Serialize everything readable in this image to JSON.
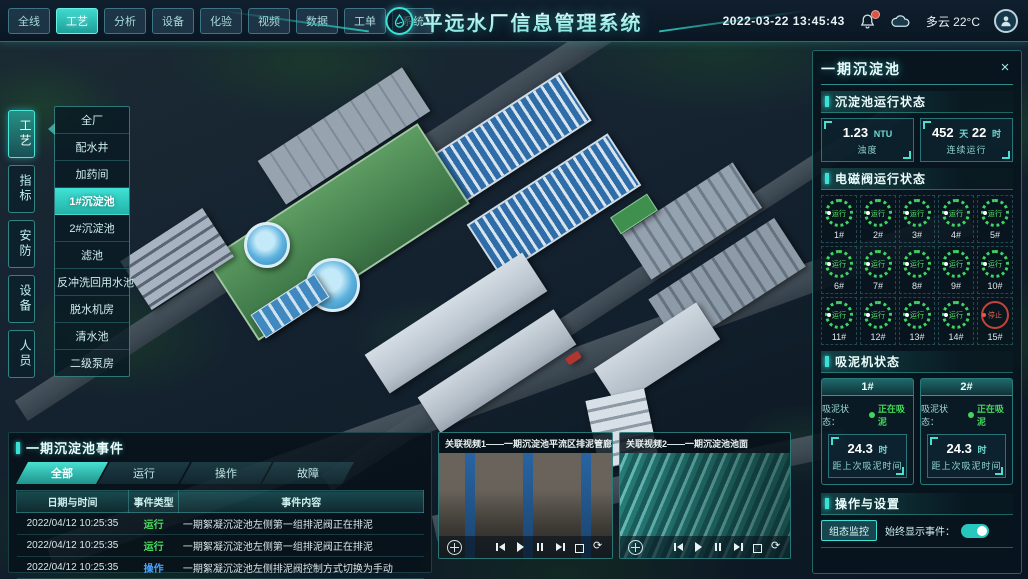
{
  "colors": {
    "accent": "#3be0d6",
    "run_green": "#44d65c",
    "op_blue": "#4aa0ff",
    "fault_red": "#c4423a",
    "panel_bg": "#071a26"
  },
  "top_bar": {
    "title": "平远水厂信息管理系统",
    "datetime": "2022-03-22 13:45:43",
    "weather": "多云 22°C",
    "tabs": [
      {
        "label": "全线"
      },
      {
        "label": "工艺",
        "cls": "active"
      },
      {
        "label": "分析"
      },
      {
        "label": "设备"
      },
      {
        "label": "化验"
      },
      {
        "label": "视频"
      },
      {
        "label": "数据"
      },
      {
        "label": "工单"
      },
      {
        "label": "系统"
      }
    ]
  },
  "sidebar": {
    "tabs": [
      {
        "label": "工艺",
        "cls": "active"
      },
      {
        "label": "指标"
      },
      {
        "label": "安防"
      },
      {
        "label": "设备"
      },
      {
        "label": "人员"
      }
    ],
    "menu": [
      {
        "label": "全厂"
      },
      {
        "label": "配水井"
      },
      {
        "label": "加药间"
      },
      {
        "label": "1#沉淀池",
        "cls": "active"
      },
      {
        "label": "2#沉淀池"
      },
      {
        "label": "滤池"
      },
      {
        "label": "反冲洗回用水池"
      },
      {
        "label": "脱水机房"
      },
      {
        "label": "清水池"
      },
      {
        "label": "二级泵房"
      }
    ]
  },
  "right_panel": {
    "title": "一期沉淀池",
    "running_section": {
      "title": "沉淀池运行状态",
      "stat1": {
        "value": "1.23",
        "unit": "NTU",
        "label": "浊度"
      },
      "stat2": {
        "value": "452",
        "unit": "天",
        "value2": "22",
        "unit2": "时",
        "label": "连续运行"
      }
    },
    "valve_section": {
      "title": "电磁阀运行状态",
      "valves": [
        {
          "id": "1#",
          "status": "运行",
          "cls": "run"
        },
        {
          "id": "2#",
          "status": "运行",
          "cls": "run"
        },
        {
          "id": "3#",
          "status": "运行",
          "cls": "run"
        },
        {
          "id": "4#",
          "status": "运行",
          "cls": "run"
        },
        {
          "id": "5#",
          "status": "运行",
          "cls": "run"
        },
        {
          "id": "6#",
          "status": "运行",
          "cls": "run"
        },
        {
          "id": "7#",
          "status": "运行",
          "cls": "run"
        },
        {
          "id": "8#",
          "status": "运行",
          "cls": "run"
        },
        {
          "id": "9#",
          "status": "运行",
          "cls": "run"
        },
        {
          "id": "10#",
          "status": "运行",
          "cls": "run"
        },
        {
          "id": "11#",
          "status": "运行",
          "cls": "run"
        },
        {
          "id": "12#",
          "status": "运行",
          "cls": "run"
        },
        {
          "id": "13#",
          "status": "运行",
          "cls": "run"
        },
        {
          "id": "14#",
          "status": "运行",
          "cls": "run"
        },
        {
          "id": "15#",
          "status": "停止",
          "cls": "stop"
        }
      ]
    },
    "mud_section": {
      "title": "吸泥机状态",
      "cards": [
        {
          "id": "1#",
          "status_label": "吸泥状态：",
          "status": "正在吸泥",
          "value": "24.3",
          "unit": "时",
          "label": "距上次吸泥时间"
        },
        {
          "id": "2#",
          "status_label": "吸泥状态：",
          "status": "正在吸泥",
          "value": "24.3",
          "unit": "时",
          "label": "距上次吸泥时间"
        }
      ]
    },
    "settings_section": {
      "title": "操作与设置",
      "button_label": "组态监控",
      "toggle_label": "始终显示事件：",
      "toggle_on": true
    }
  },
  "events_panel": {
    "title": "一期沉淀池事件",
    "tabs": [
      {
        "label": "全部",
        "cls": "active"
      },
      {
        "label": "运行"
      },
      {
        "label": "操作"
      },
      {
        "label": "故障"
      }
    ],
    "columns": [
      {
        "label": "日期与时间"
      },
      {
        "label": "事件类型"
      },
      {
        "label": "事件内容"
      }
    ],
    "rows": [
      {
        "time": "2022/04/12 10:25:35",
        "type": "运行",
        "cls": "run",
        "content": "一期絮凝沉淀池左侧第一组排泥阀正在排泥"
      },
      {
        "time": "2022/04/12 10:25:35",
        "type": "运行",
        "cls": "run",
        "content": "一期絮凝沉淀池左侧第一组排泥阀正在排泥"
      },
      {
        "time": "2022/04/12 10:25:35",
        "type": "操作",
        "cls": "op",
        "content": "一期絮凝沉淀池左侧排泥阀控制方式切换为手动"
      },
      {
        "time": "2022/04/12 10:25:35",
        "type": "故障",
        "cls": "fault",
        "content": "一期絮凝沉淀池左侧第二组排泥阀启动失败"
      }
    ]
  },
  "videos": [
    {
      "title": "关联视频1——一期沉淀池平流区排泥管廊"
    },
    {
      "title": "关联视频2——一期沉淀池池面"
    }
  ],
  "icons": {
    "top": [
      "bell-icon",
      "cloud-icon",
      "avatar-icon",
      "logo-water-icon",
      "close-icon"
    ],
    "video_controls": [
      "ptz-pad-icon",
      "prev-icon",
      "play-icon",
      "pause-icon",
      "next-icon",
      "fullscreen-icon",
      "loop-icon"
    ]
  }
}
